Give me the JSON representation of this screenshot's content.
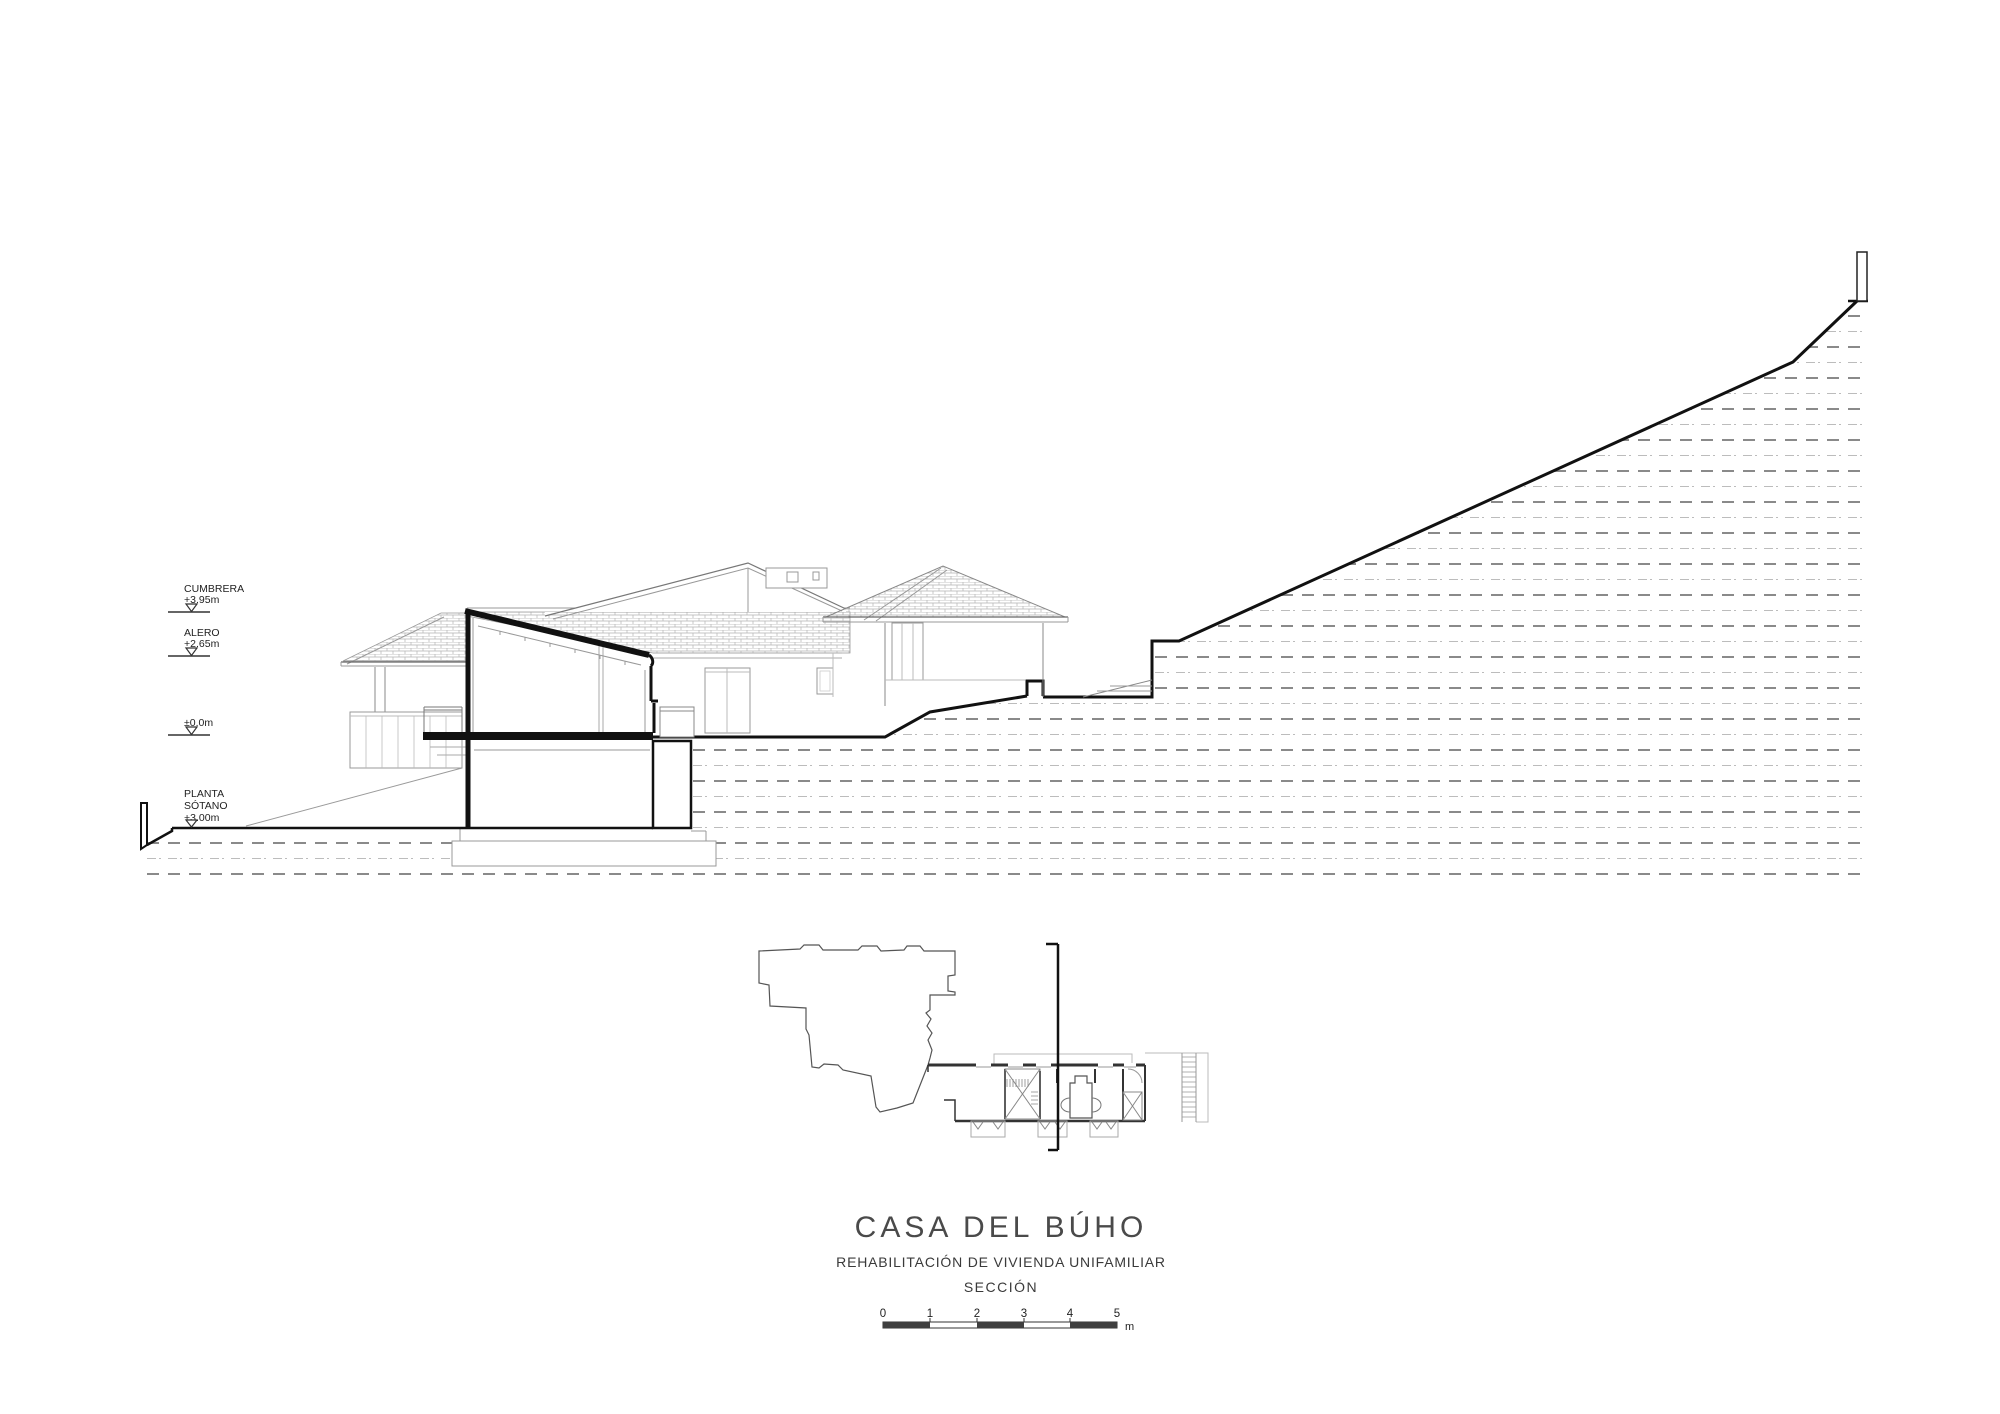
{
  "title": "CASA DEL BÚHO",
  "subtitle": "REHABILITACIÓN DE VIVIENDA UNIFAMILIAR",
  "drawing_label": "SECCIÓN",
  "levels": {
    "cumbrera": {
      "label": "CUMBRERA",
      "value": "+3.95m"
    },
    "alero": {
      "label": "ALERO",
      "value": "+2.65m"
    },
    "zero": {
      "value": "±0.0m"
    },
    "sotano": {
      "label_line1": "PLANTA",
      "label_line2": "SÓTANO",
      "value": "+3.00m"
    }
  },
  "scalebar": {
    "ticks": [
      "0",
      "1",
      "2",
      "3",
      "4",
      "5"
    ],
    "unit": "m"
  },
  "colors": {
    "ink": "#111111",
    "thin_line": "#888888",
    "earth_dash": "#8a8a8a",
    "earth_fine": "#bcbcbc",
    "scale_fill": "#3f3f3f",
    "title_text": "#4a4a4a"
  }
}
